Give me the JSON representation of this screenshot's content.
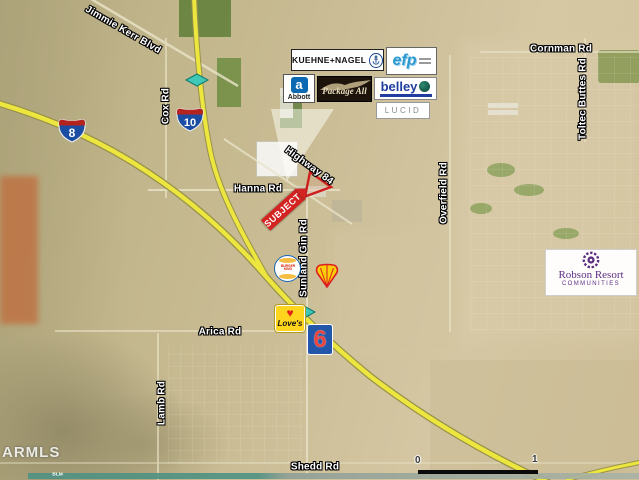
{
  "roads": {
    "jimmie_kerr": "Jimmie Kerr Blvd",
    "cox": "Cox Rd",
    "cornman": "Cornman Rd",
    "toltec_buttes": "Toltec Buttes Rd",
    "highway_84": "Highway 84",
    "hanna": "Hanna Rd",
    "overfield": "Overfield Rd",
    "sunland_gin": "Sunland Gin Rd",
    "arica": "Arica Rd",
    "lamb": "Lamb Rd",
    "shedd": "Shedd Rd"
  },
  "shields": {
    "i8": "8",
    "i10": "10"
  },
  "subject": {
    "label": "SUBJECT"
  },
  "businesses": {
    "kuehne_nagel": "KUEHNE+NAGEL",
    "efp": "efp",
    "abbott_mark": "a",
    "abbott": "Abbott",
    "package_all": "Package All",
    "belley": "belley",
    "lucid": "LUCID",
    "burger_king_top": "BURGER",
    "burger_king_bottom": "KING",
    "loves": "Love's",
    "motel6": "6",
    "robson_name": "Robson Resort",
    "robson_sub": "COMMUNITIES"
  },
  "footer": {
    "watermark": "ARMLS",
    "blm": "BLM",
    "scale_start": "0",
    "scale_end": "1"
  },
  "colors": {
    "highway_yellow": "#ece63f",
    "interchange_teal": "#3fc8b8",
    "subject_red": "#d42422",
    "shield_blue": "#1b4ea3",
    "shield_red": "#b5231f",
    "robson_purple": "#5c2d82",
    "efp_blue": "#2e9ad0",
    "belley_blue": "#1e3d9e",
    "abbott_blue": "#0b68b2",
    "shell_red": "#dd1d21",
    "shell_yellow": "#fbce07",
    "loves_yellow": "#ffd51e",
    "motel6_blue": "#2156a8",
    "motel6_red": "#e8453c"
  }
}
